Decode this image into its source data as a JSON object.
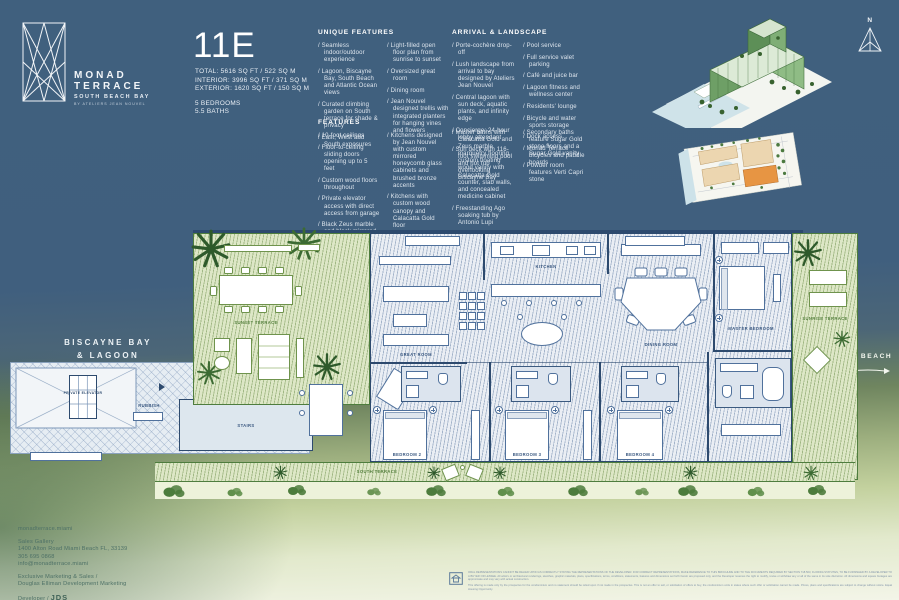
{
  "brand": {
    "line1": "MONAD",
    "line2": "TERRACE",
    "subtitle": "SOUTH BEACH BAY",
    "byline": "BY ATELIERS JEAN NOUVEL"
  },
  "unit": {
    "number": "11E",
    "total": "TOTAL: 5616 SQ FT / 522  SQ M",
    "interior": "INTERIOR: 3996 SQ FT / 371 SQ M",
    "exterior": "EXTERIOR: 1620 SQ FT / 150 SQ M",
    "bedrooms": "5 BEDROOMS",
    "baths": "5.5 BATHS"
  },
  "sections": {
    "unique": {
      "title": "UNIQUE FEATURES",
      "col1": [
        "Seamless indoor/outdoor experience",
        "Lagoon, Biscayne Bay, South Beach and Atlantic Ocean views",
        "Curated climbing garden on South terrace for shade & privacy",
        "East, West and South exposures"
      ],
      "col2": [
        "Light-filled open floor plan from sunrise to sunset",
        "Oversized great room",
        "Dining room",
        "Jean Nouvel designed trellis with integrated planters for hanging vines and flowers"
      ]
    },
    "arrival": {
      "title": "ARRIVAL & LANDSCAPE",
      "col1": [
        "Porte-cochère drop-off",
        "Lush landscape from arrival to bay designed by Ateliers Jean Nouvel",
        "Central lagoon with sun deck, aquatic plants, and infinity edge",
        "Concierge; 24-hour lobby attendant",
        "Sun deck with 116-foot swimming pool and hot tub overlooking Biscayne Bay"
      ],
      "col2": [
        "Pool service",
        "Full service valet parking",
        "Café and juice bar",
        "Lagoon fitness and wellness center",
        "Residents' lounge",
        "Bicycle and water sports storage",
        "Dock access",
        "Monad Terrace bicycles and paddle boards"
      ]
    },
    "features": {
      "title": "FEATURES",
      "col1": [
        "10-foot ceilings",
        "Floor-to-ceiling sliding doors opening up to 5 feet",
        "Custom wood floors throughout",
        "Private elevator access with direct access from garage",
        "Black Zeus marble and black mirrored entry",
        "Custom flush doors",
        "Sculptural cantilevered marble island in Calacatta Gold"
      ],
      "col2": [
        "Kitchens designed by Jean Nouvel with custom mirrored honeycomb glass cabinets and brushed bronze accents",
        "Kitchens with custom wood canopy and Calacatta Gold floor",
        "Fully integrated Gaggenau appliances",
        "Custom marble wine rack",
        "Integrated wine cooler"
      ],
      "col3": [
        "Master baths with Calacatta Gold and Zeus marble marquetry flooring, custom floating wood vanity with Calacatta Gold counter, slab walls, and concealed medicine cabinet",
        "Freestanding Ago soaking tub by Antonio Lupi",
        "Steam shower in master bath",
        "Vola fixtures"
      ],
      "col4": [
        "Secondary baths feature Sugar Gold stone floors and a Sugar Gold vanity",
        "Powder room features Verti Capri stone"
      ]
    }
  },
  "compass": {
    "label": "N"
  },
  "context": {
    "bay_line1": "BISCAYNE BAY",
    "bay_line2": "& LAGOON",
    "beach": "MIAMI BEACH"
  },
  "floorplan": {
    "rooms": {
      "sunset_terrace": "SUNSET TERRACE",
      "great_room": "GREAT ROOM",
      "kitchen": "KITCHEN",
      "dining_room": "DINING ROOM",
      "master_bedroom": "MASTER BEDROOM",
      "bedroom2": "BEDROOM 2",
      "bedroom3": "BEDROOM 3",
      "bedroom4": "BEDROOM 4",
      "sunrise_terrace": "SUNRISE TERRACE",
      "south_terrace": "SOUTH TERRACE",
      "stairs": "STAIRS",
      "private_elevator": "PRIVATE ELEVATOR",
      "rubbish": "RUBBISH",
      "foyer": "FOYER"
    }
  },
  "footer": {
    "website": "monadterrace.miami",
    "gallery": "Sales Gallery",
    "address": "1400 Alton Road Miami Beach FL, 33139",
    "phone": "305 695 0868",
    "email": "info@monadterrace.miami",
    "marketing_line1": "Exclusive Marketing & Sales /",
    "marketing_line2": "Douglas Elliman Development Marketing",
    "developer_label": "Developer /",
    "developer_name": "JDS",
    "disclaimer_p1": "ORAL REPRESENTATIONS CANNOT BE RELIED UPON AS CORRECTLY STATING THE REPRESENTATIONS OF THE DEVELOPER. FOR CORRECT REPRESENTATIONS, MAKE REFERENCE TO THIS BROCHURE AND TO THE DOCUMENTS REQUIRED BY SECTION 718.503, FLORIDA STATUTES, TO BE FURNISHED BY A DEVELOPER TO A BUYER OR LESSEE. All artist's or architectural renderings, sketches, graphic materials, plans, specifications, terms, conditions, statements, features and dimensions set forth herein are proposed only, and the Developer reserves the right to modify, revise or withdraw any or all of the same in its sole discretion. All dimensions and square footages are approximate and may vary with actual construction.",
    "disclaimer_p2": "This offering is made only by the prospectus for the condominium and no statement should be relied upon if not made in the prospectus. This is not an offer to sell, or solicitation of offers to buy, the condominium units in states where such offer or solicitation cannot be made. Prices, plans and specifications are subject to change without notice. Equal Housing Opportunity."
  },
  "colors": {
    "background_blue": "#40607e",
    "terrace_green": "#dde7c6",
    "plan_wall_navy": "#2d4a6e",
    "site_highlight_orange": "#e79543",
    "footer_text_green": "#4d7066"
  }
}
